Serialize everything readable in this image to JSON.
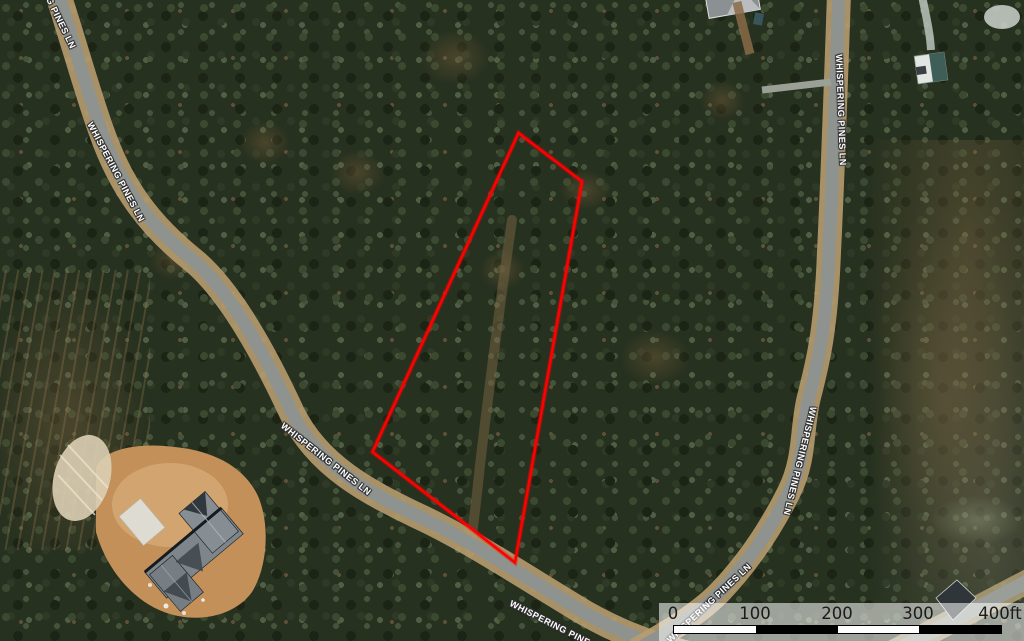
{
  "map": {
    "road_name": "WHISPERING PINES LN",
    "road_labels": [
      {
        "text": "G PINES LN"
      },
      {
        "text": "WHISPERING PINES LN"
      },
      {
        "text": "WHISPERING PINES LN"
      },
      {
        "text": "WHISPERING PINES LN"
      },
      {
        "text": "WHISPERING PINES LN"
      },
      {
        "text": "WHISPERING PINES LN"
      },
      {
        "text": "WHISPERING PINES LN"
      }
    ],
    "parcel": {
      "outline_color": "#ff0000"
    },
    "scale_bar": {
      "ticks": [
        "0",
        "100",
        "200",
        "300",
        "400ft"
      ]
    }
  }
}
